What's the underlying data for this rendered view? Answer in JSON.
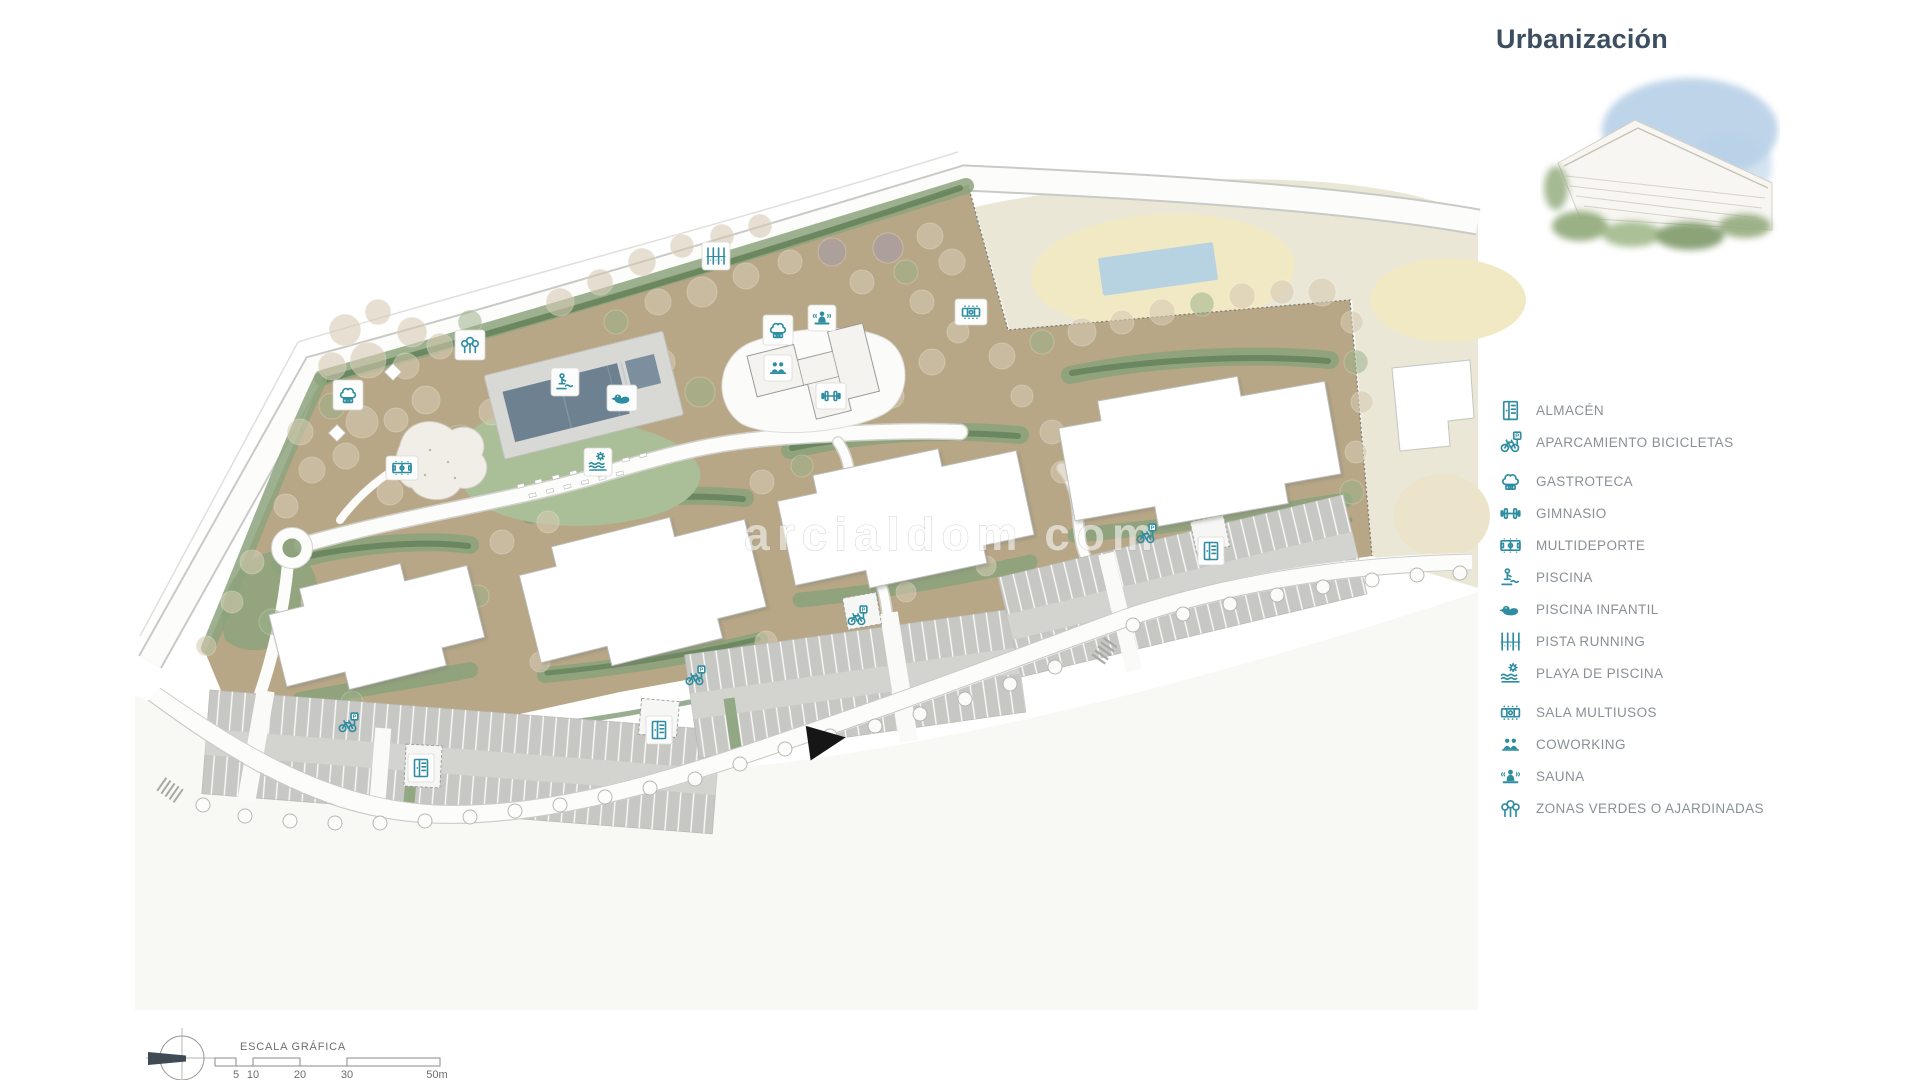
{
  "title": "Urbanización",
  "watermark": "arcialdom com",
  "legend": {
    "bike_sign": "P",
    "items": [
      {
        "id": "almacen",
        "label": "ALMACÉN",
        "icon": "wardrobe-icon"
      },
      {
        "id": "aparcamiento-bicicletas",
        "label": "APARCAMIENTO BICICLETAS",
        "icon": "bicycle-parking-icon"
      },
      {
        "id": "gastroteca",
        "label": "GASTROTECA",
        "icon": "chef-hat-icon"
      },
      {
        "id": "gimnasio",
        "label": "GIMNASIO",
        "icon": "dumbbell-icon"
      },
      {
        "id": "multideporte",
        "label": "MULTIDEPORTE",
        "icon": "sports-court-icon"
      },
      {
        "id": "piscina",
        "label": "PISCINA",
        "icon": "pool-person-icon"
      },
      {
        "id": "piscina-infantil",
        "label": "PISCINA INFANTIL",
        "icon": "duck-icon"
      },
      {
        "id": "pista-running",
        "label": "PISTA RUNNING",
        "icon": "running-track-icon"
      },
      {
        "id": "playa-de-piscina",
        "label": "PLAYA DE PISCINA",
        "icon": "sun-waves-icon"
      },
      {
        "id": "sala-multiusos",
        "label": "SALA MULTIUSOS",
        "icon": "multiuse-table-icon"
      },
      {
        "id": "coworking",
        "label": "COWORKING",
        "icon": "coworking-people-icon"
      },
      {
        "id": "sauna",
        "label": "SAUNA",
        "icon": "sauna-person-icon"
      },
      {
        "id": "zonas-verdes",
        "label": "ZONAS VERDES O AJARDINADAS",
        "icon": "trees-icon"
      }
    ]
  },
  "scale_bar": {
    "label": "ESCALA GRÁFICA",
    "ticks": [
      "5",
      "10",
      "20",
      "30",
      "50m"
    ]
  },
  "colors": {
    "accent_teal": "#2e8da0",
    "title_blue": "#3c4e60",
    "legend_text": "#8a9095",
    "parcel_tan": "#b8a786",
    "beige_area": "#eae7d6",
    "oval_yellow": "#f1e9c4",
    "pool_blue_light": "#b7d3e2",
    "pool_slate": "#6e8191",
    "green_medium": "#8ca37c",
    "green_lawn": "#aabf97",
    "hedge_dark": "#5e7d55",
    "parking_gray": "#c7c7c4",
    "road_white": "#fcfcfb"
  }
}
